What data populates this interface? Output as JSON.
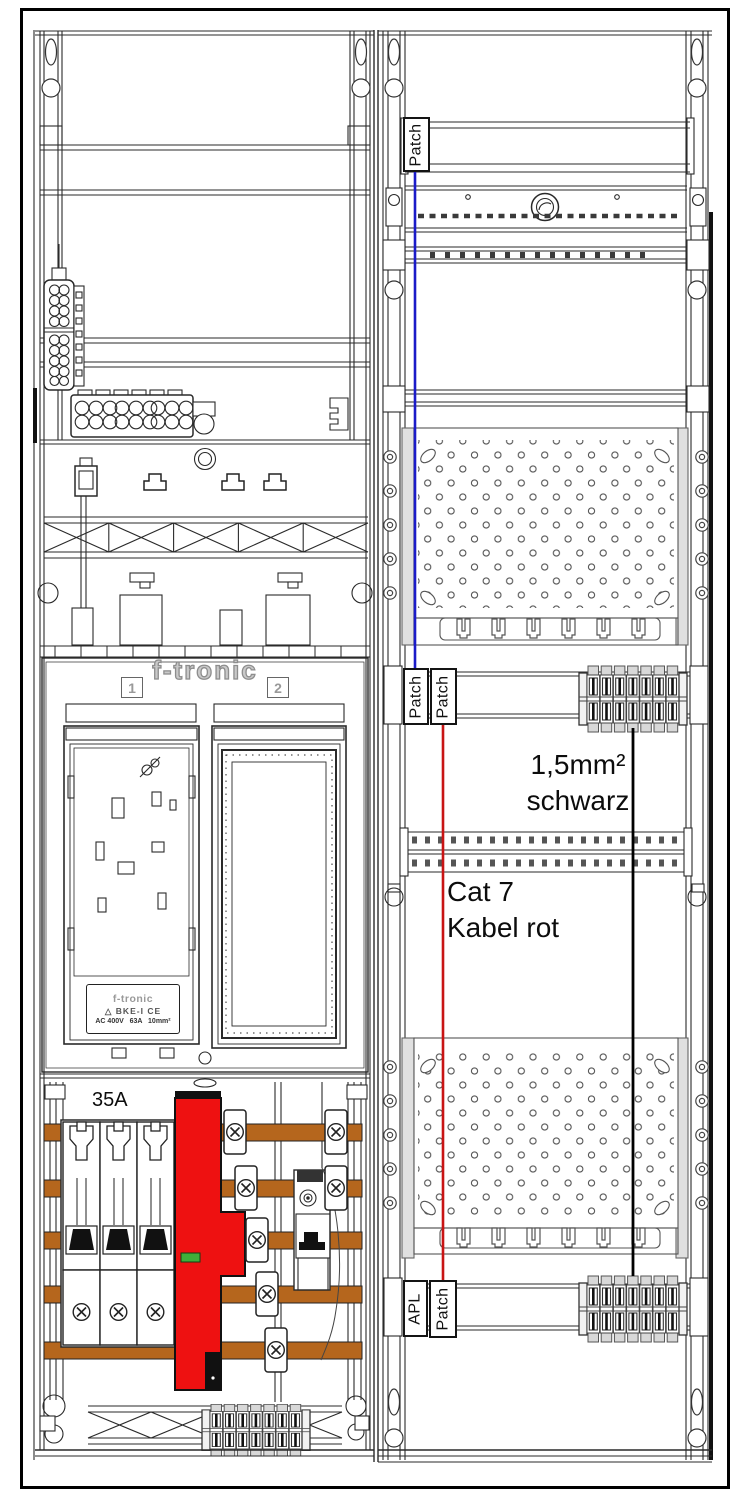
{
  "cabinet": {
    "left_field": {
      "brand_logo": "f-tronic",
      "meter_field_1_label": "1",
      "meter_field_2_label": "2",
      "bke_label": {
        "brand": "f-tronic",
        "logo_glyph": "△",
        "model": "BKE-I",
        "ce_mark": "CE",
        "ratings": "AC 400V   63A   10mm²"
      },
      "fuse_rating": "35A"
    },
    "right_field": {
      "patch_label_top": "Patch",
      "patch_label_mid_left": "Patch",
      "patch_label_mid_right": "Patch",
      "apl_label": "APL",
      "patch_label_bottom": "Patch",
      "black_cable_note": {
        "line1": "1,5mm²",
        "line2": "schwarz"
      },
      "red_cable_note": {
        "line1": "Cat 7",
        "line2": "Kabel rot"
      }
    },
    "wires": {
      "blue": "#1b1bc8",
      "red": "#c81414",
      "black": "#000000"
    },
    "colors": {
      "busbar": "#b5661d",
      "sls_switch_red": "#ee1111",
      "indicator_green": "#3fae3a"
    }
  }
}
